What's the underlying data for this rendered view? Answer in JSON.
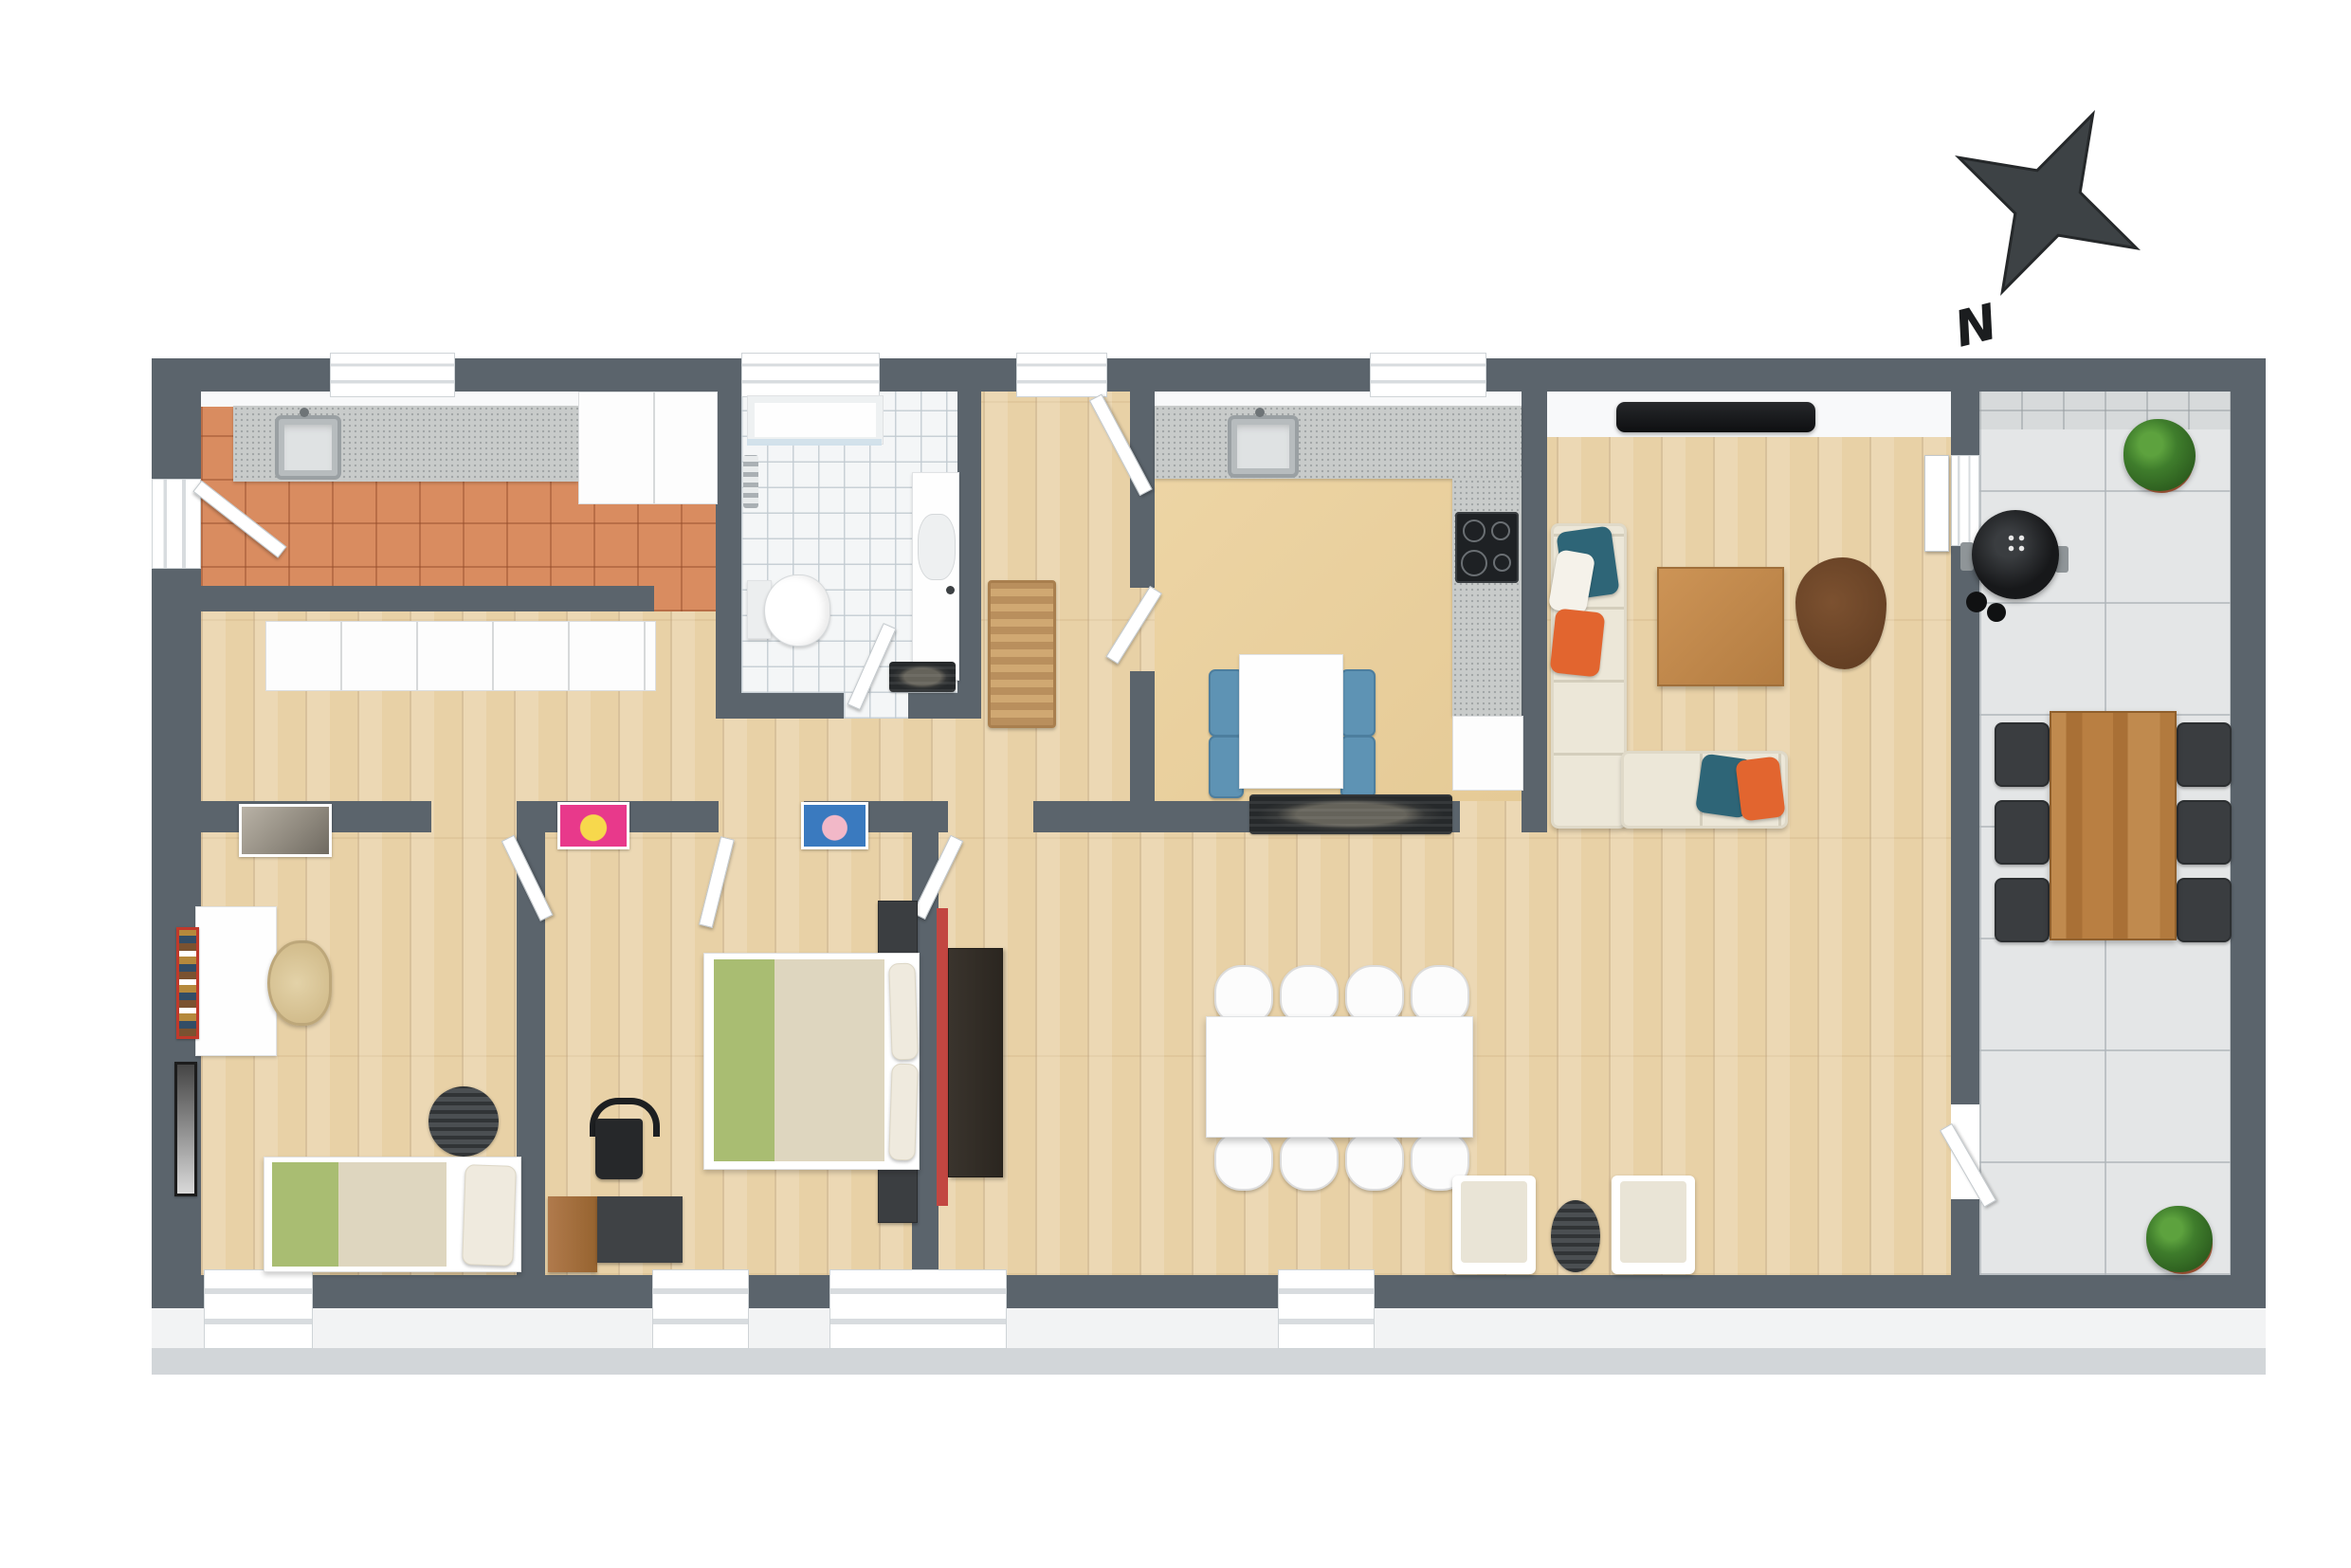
{
  "scene": {
    "type": "3d-floor-plan-render",
    "background": "#ffffff",
    "compass": {
      "label": "N"
    }
  },
  "palette": {
    "wall": "#5b646c",
    "wall-face": "#f8f9fa",
    "wood": "#e8d1a6",
    "terracotta": "#d98c60",
    "bath-tile": "#f4f6f7",
    "beige-floor": "#ead1a1",
    "patio-tile": "#e4e6e7",
    "counter": "#c8cbca",
    "cream-sofa": "#ece7d8",
    "pillow-teal": "#2e6577",
    "pillow-orange": "#e2652f",
    "chair-blue": "#5e93b4",
    "blanket-green": "#a9bd72",
    "blanket-beige": "#ded6bf",
    "wood-furniture": "#c08a4e",
    "dark-furniture": "#3a3d40",
    "rug-brown": "#6e4527",
    "plant-green": "#3f7d2c",
    "pot-terracotta": "#b8613e",
    "compass-color": "#3d4245"
  },
  "rooms": [
    {
      "name": "kitchen",
      "floor": "terracotta-tile",
      "furniture": [
        "straight-counter-with-sink",
        "faucet",
        "tall-cabinet-fridge",
        "exterior-door",
        "facade-window"
      ]
    },
    {
      "name": "hallway",
      "floor": "wood",
      "furniture": [
        "white-wardrobe-row",
        "wall-picture"
      ]
    },
    {
      "name": "bathroom",
      "floor": "white-tile",
      "furniture": [
        "shower",
        "toilet",
        "vanity-sink",
        "towel-radiator",
        "bath-mat",
        "door"
      ]
    },
    {
      "name": "entry-hall",
      "floor": "wood",
      "furniture": [
        "entry-door",
        "slatted-shoe-bench"
      ]
    },
    {
      "name": "kitchen-diner",
      "floor": "smooth-beige",
      "furniture": [
        "l-shaped-counter",
        "sink",
        "cooktop-4-burner",
        "base-cabinet",
        "small-dining-table",
        "4-blue-chairs",
        "dark-runner-rug",
        "door"
      ]
    },
    {
      "name": "living-room",
      "floor": "wood",
      "furniture": [
        "wall-tv",
        "l-shaped-sofa",
        "teal-pillows",
        "orange-pillows",
        "wooden-coffee-table",
        "brown-rug",
        "open-door-leaf"
      ]
    },
    {
      "name": "dining-area",
      "floor": "wood",
      "furniture": [
        "large-dining-table",
        "8-white-chairs",
        "2-cream-armchairs",
        "oval-dark-rug",
        "dark-wardrobe-red-back",
        "window"
      ]
    },
    {
      "name": "bedroom-1",
      "floor": "wood",
      "furniture": [
        "single-bed-green-beige",
        "white-desk",
        "office-chair",
        "round-striped-rug",
        "red-framed-picture",
        "black-framed-picture",
        "window"
      ]
    },
    {
      "name": "bedroom-2",
      "floor": "wood",
      "furniture": [
        "double-bed-green-beige",
        "2-dark-nightstands",
        "black-chair",
        "desk-dark-and-wood",
        "pink-pop-art-poster",
        "blue-pop-art-poster",
        "window"
      ]
    },
    {
      "name": "patio",
      "floor": "large-grey-tile",
      "furniture": [
        "kettle-bbq-grill",
        "outdoor-wooden-table",
        "6-dark-chairs",
        "potted-plant-north",
        "potted-plant-south",
        "patio-door"
      ]
    }
  ]
}
